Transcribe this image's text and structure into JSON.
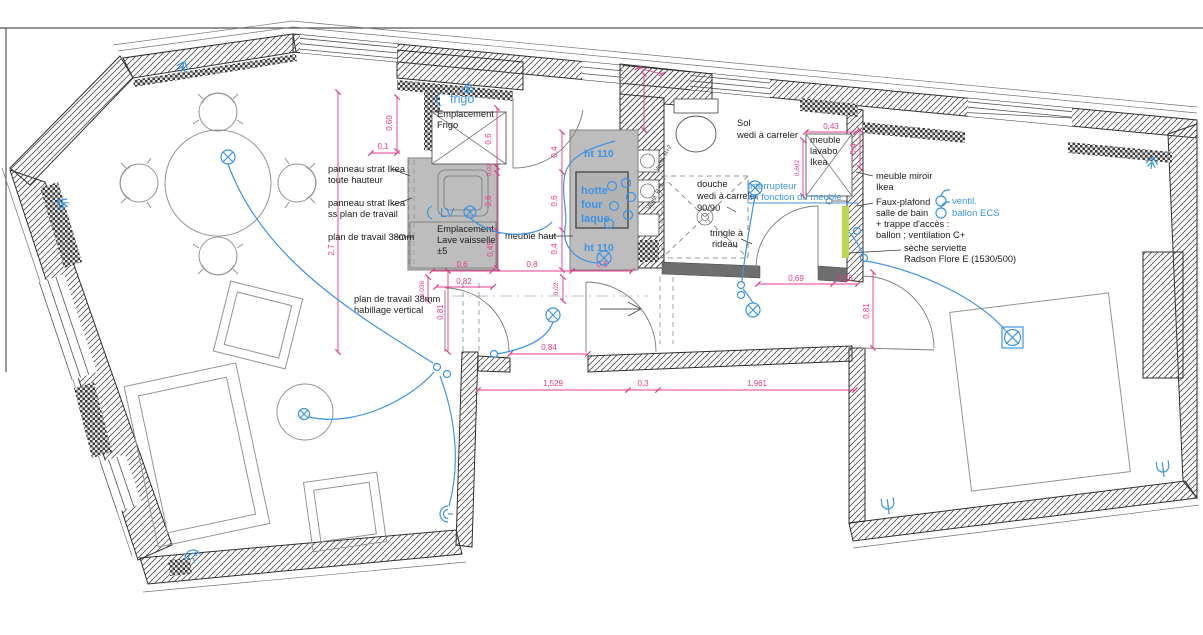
{
  "meta": {
    "drawing_type": "apartment floor plan with electrical and joinery annotations"
  },
  "colors": {
    "dimension": "#E8378E",
    "electrical": "#3E94E4",
    "wall": "#2f2f2f",
    "cabinet_fill": "#bdbdbd",
    "highlight_green": "#b9d94c"
  },
  "annotations": {
    "panneau_full_1": "panneau strat Ikea",
    "panneau_full_2": "toute hauteur",
    "panneau_ss_1": "panneau strat Ikea",
    "panneau_ss_2": "ss plan de travail",
    "plan_travail": "plan de travail 38mm",
    "empl_frigo_1": "Emplacement",
    "empl_frigo_2": "Frigo",
    "empl_lv_1": "Emplacement",
    "empl_lv_2": "Lave vaisselle",
    "empl_lv_3": "±5",
    "meuble_haut": "meuble haut",
    "sol_1": "Sol",
    "sol_2": "wedi à carreler",
    "douche_1": "douche",
    "douche_2": "wedi à carreler",
    "douche_3": "90/90",
    "tringle_1": "tringle à",
    "tringle_2": "rideau",
    "lavabo_1": "meuble",
    "lavabo_2": "lavabo",
    "lavabo_3": "Ikea",
    "miroir_1": "meuble miroir",
    "miroir_2": "Ikea",
    "faux_plafond_1": "Faux-plafond",
    "faux_plafond_2": "salle de bain",
    "faux_plafond_3": "+ trappe d'accès :",
    "faux_plafond_4": "ballon ; ventilation C+",
    "seche_1": "sèche serviette",
    "seche_2": "Radson Flore E (1530/500)",
    "plan_vertical_1": "plan de travail 38mm",
    "plan_vertical_2": "habillage vertical"
  },
  "electrical_labels": {
    "frigo": "frigo",
    "lv": "LV",
    "ht110_top": "ht 110",
    "ht110_bottom": "ht 110",
    "hotte_1": "hotte",
    "hotte_2": "four",
    "hotte_3": "laque",
    "interrupteur_1": "interrupteur",
    "interrupteur_2": "en fonction du meuble",
    "ventil_1": "ventil.",
    "ventil_2": "ballon ECS",
    "shaft_1": "Ventil. R+2",
    "shaft_2": "Ventil. R+1"
  },
  "dimensions": {
    "d060": "0,60",
    "d01": "0,1",
    "d06_frigo": "0,6",
    "d002_a": "0,02",
    "d06_sink": "0,6",
    "d045": "0,45",
    "d27": "2,7",
    "d0036": "0,036",
    "d06_base_l": "0,6",
    "d08_base": "0,8",
    "d06_base_r": "0,6",
    "d082": "0,82",
    "d081_hall": "0,81",
    "d002_b": "0,02",
    "d084": "0,84",
    "d1529": "1,529",
    "d03": "0,3",
    "d1961": "1,961",
    "d069": "0,69",
    "d028": "0,28",
    "d081_bed": "0,81",
    "d043": "0,43",
    "d0602": "0,602",
    "d04_wall": "0,4",
    "d04_top": "0,4",
    "d06_mid": "0,6",
    "d04_bot": "0,4"
  }
}
